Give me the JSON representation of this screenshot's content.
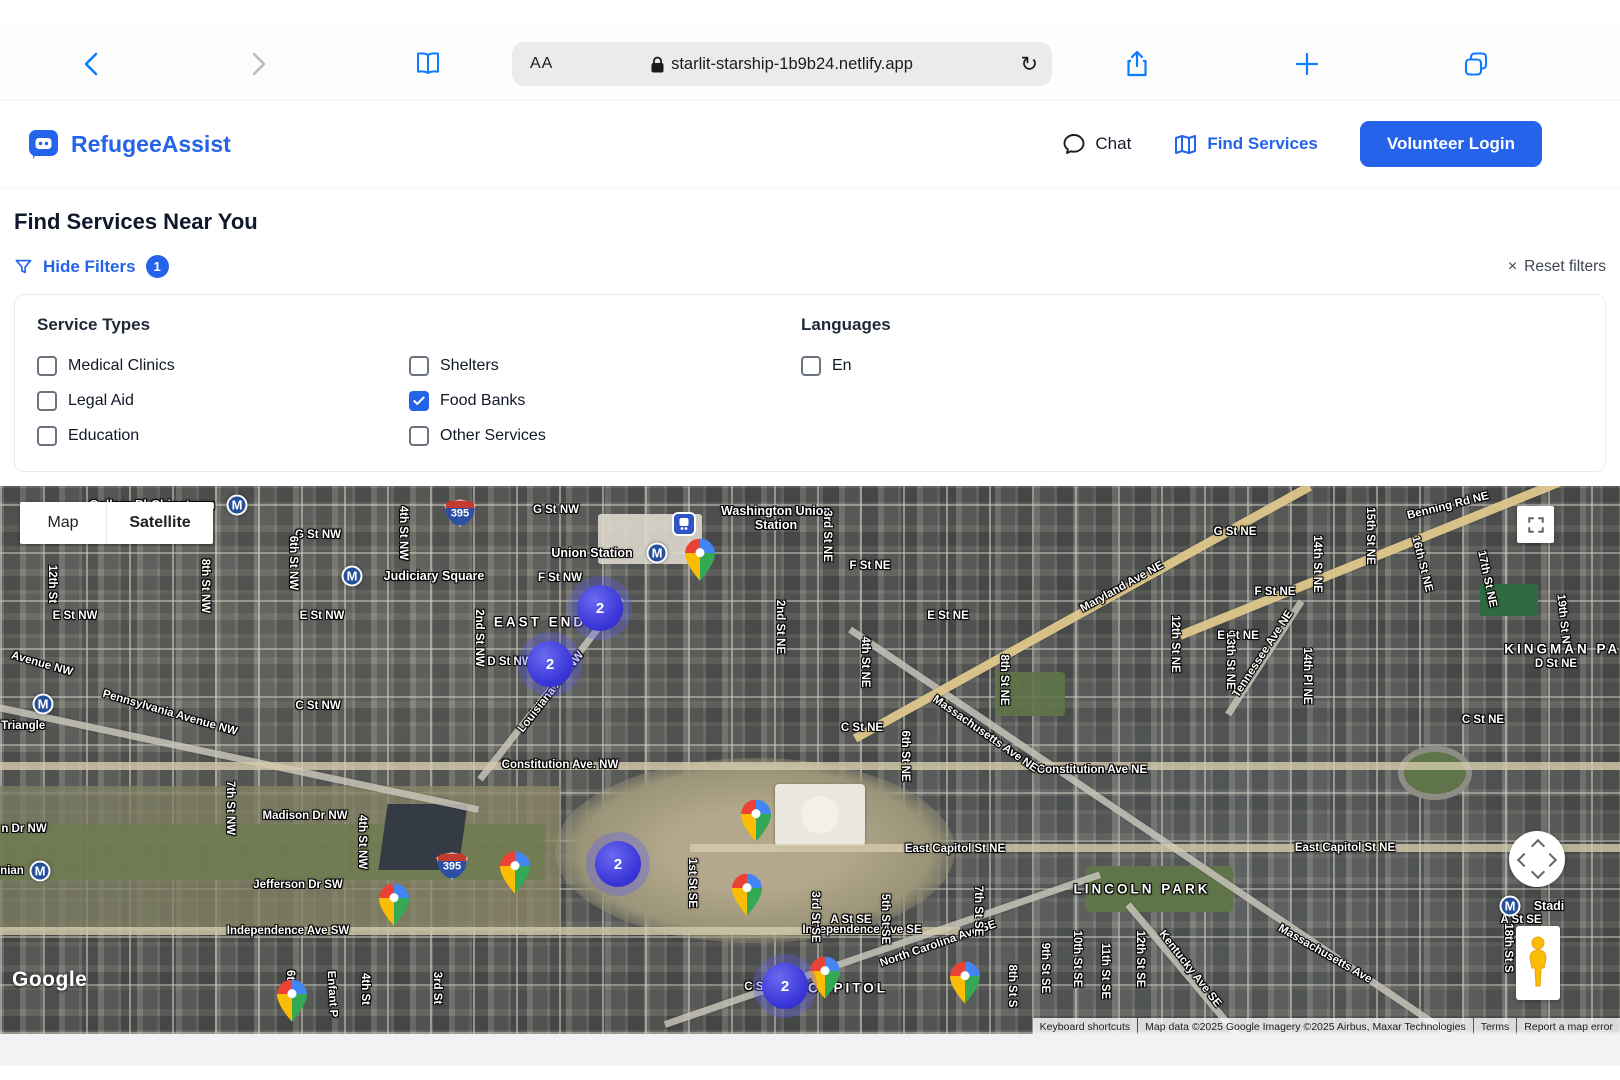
{
  "browser": {
    "text_size_label": "AA",
    "url": "starlit-starship-1b9b24.netlify.app",
    "reload_glyph": "↻"
  },
  "header": {
    "brand": "RefugeeAssist",
    "nav_chat": "Chat",
    "nav_find_services": "Find Services",
    "login": "Volunteer Login"
  },
  "page": {
    "title": "Find Services Near You",
    "hide_filters": "Hide Filters",
    "filter_count": "1",
    "reset_glyph": "×",
    "reset": "Reset filters"
  },
  "filters": {
    "service_types_label": "Service Types",
    "services": [
      {
        "label": "Medical Clinics",
        "checked": false
      },
      {
        "label": "Legal Aid",
        "checked": false
      },
      {
        "label": "Education",
        "checked": false
      },
      {
        "label": "Shelters",
        "checked": false
      },
      {
        "label": "Food Banks",
        "checked": true
      },
      {
        "label": "Other Services",
        "checked": false
      }
    ],
    "languages_label": "Languages",
    "languages": [
      {
        "label": "En",
        "checked": false
      }
    ]
  },
  "map": {
    "toggle_map": "Map",
    "toggle_satellite": "Satellite",
    "google_logo": "Google",
    "attribution": [
      "Keyboard shortcuts",
      "Map data ©2025 Google Imagery ©2025 Airbus, Maxar Technologies",
      "Terms",
      "Report a map error"
    ],
    "accent_colors": {
      "brand_blue": "#2563eb",
      "cluster_blue": "#3a35d8",
      "pin_red": "#EA4335",
      "pin_blue": "#4285F4",
      "pin_green": "#34A853",
      "pin_yellow": "#FBBC04"
    },
    "clusters": [
      {
        "x": 600,
        "y": 122,
        "count": "2"
      },
      {
        "x": 550,
        "y": 178,
        "count": "2"
      },
      {
        "x": 618,
        "y": 378,
        "count": "2"
      },
      {
        "x": 785,
        "y": 500,
        "count": "2"
      }
    ],
    "pins": [
      {
        "x": 700,
        "y": 77
      },
      {
        "x": 756,
        "y": 338
      },
      {
        "x": 515,
        "y": 390
      },
      {
        "x": 394,
        "y": 422
      },
      {
        "x": 747,
        "y": 412
      },
      {
        "x": 825,
        "y": 495
      },
      {
        "x": 965,
        "y": 500
      },
      {
        "x": 292,
        "y": 518
      }
    ],
    "metro_stations": [
      {
        "x": 237,
        "y": 19
      },
      {
        "x": 352,
        "y": 90
      },
      {
        "x": 657,
        "y": 67
      },
      {
        "x": 43,
        "y": 218
      },
      {
        "x": 40,
        "y": 385
      },
      {
        "x": 1510,
        "y": 420
      }
    ],
    "transit_icon": {
      "x": 684,
      "y": 38
    },
    "shields": [
      {
        "x": 460,
        "y": 27,
        "label": "395"
      },
      {
        "x": 452,
        "y": 380,
        "label": "395"
      }
    ],
    "labels": [
      {
        "t": "Gallery Pl-Chinatown",
        "x": 152,
        "y": 19,
        "r": 0,
        "k": "sta"
      },
      {
        "t": "G St NW",
        "x": 318,
        "y": 49,
        "r": 0,
        "k": "st"
      },
      {
        "t": "G St NW",
        "x": 556,
        "y": 24,
        "r": 0,
        "k": "st"
      },
      {
        "t": "Judiciary Square",
        "x": 434,
        "y": 90,
        "r": 0,
        "k": "sta"
      },
      {
        "t": "Union Station",
        "x": 592,
        "y": 67,
        "r": 0,
        "k": "sta"
      },
      {
        "t": "Washington Union Station",
        "x": 776,
        "y": 32,
        "r": 0,
        "k": "sta2"
      },
      {
        "t": "F St NW",
        "x": 560,
        "y": 92,
        "r": 0,
        "k": "st"
      },
      {
        "t": "EAST END",
        "x": 540,
        "y": 136,
        "r": 0,
        "k": "area"
      },
      {
        "t": "E St NW",
        "x": 75,
        "y": 130,
        "r": 0,
        "k": "st"
      },
      {
        "t": "E St NW",
        "x": 322,
        "y": 130,
        "r": 0,
        "k": "st"
      },
      {
        "t": "D St NW",
        "x": 510,
        "y": 176,
        "r": 0,
        "k": "st"
      },
      {
        "t": "C St NW",
        "x": 318,
        "y": 220,
        "r": 0,
        "k": "st"
      },
      {
        "t": "Madison Dr NW",
        "x": 305,
        "y": 330,
        "r": 0,
        "k": "st"
      },
      {
        "t": "n Dr NW",
        "x": 24,
        "y": 343,
        "r": 0,
        "k": "st"
      },
      {
        "t": "Jefferson Dr SW",
        "x": 298,
        "y": 399,
        "r": 0,
        "k": "st"
      },
      {
        "t": "Independence Ave SW",
        "x": 288,
        "y": 445,
        "r": 0,
        "k": "st"
      },
      {
        "t": "Independence Ave SE",
        "x": 862,
        "y": 444,
        "r": 0,
        "k": "st"
      },
      {
        "t": "Constitution Ave. NW",
        "x": 560,
        "y": 279,
        "r": 0,
        "k": "st"
      },
      {
        "t": "Constitution Ave NE",
        "x": 1092,
        "y": 284,
        "r": 0,
        "k": "st"
      },
      {
        "t": "l Triangle",
        "x": 20,
        "y": 240,
        "r": 0,
        "k": "st"
      },
      {
        "t": "nian",
        "x": 12,
        "y": 385,
        "r": 0,
        "k": "st"
      },
      {
        "t": "Avenue NW",
        "x": 42,
        "y": 178,
        "r": 16,
        "k": "st"
      },
      {
        "t": "Pennsylvania Avenue NW",
        "x": 170,
        "y": 227,
        "r": 16,
        "k": "st"
      },
      {
        "t": "Louisiana Ave NW",
        "x": 551,
        "y": 206,
        "r": -52,
        "k": "st"
      },
      {
        "t": "Massachusetts Ave NE",
        "x": 985,
        "y": 248,
        "r": 35,
        "k": "st"
      },
      {
        "t": "Massachusetts Ave",
        "x": 1325,
        "y": 468,
        "r": 30,
        "k": "st"
      },
      {
        "t": "Maryland Ave NE",
        "x": 1122,
        "y": 101,
        "r": -29,
        "k": "st"
      },
      {
        "t": "Tennessee Ave NE",
        "x": 1263,
        "y": 168,
        "r": -57,
        "k": "st"
      },
      {
        "t": "North Carolina Ave SE",
        "x": 938,
        "y": 458,
        "r": -19,
        "k": "st"
      },
      {
        "t": "Benning Rd NE",
        "x": 1448,
        "y": 20,
        "r": -14,
        "k": "st"
      },
      {
        "t": "Kentucky Ave SE",
        "x": 1190,
        "y": 483,
        "r": 52,
        "k": "st"
      },
      {
        "t": "East Capitol St NE",
        "x": 955,
        "y": 363,
        "r": 0,
        "k": "st"
      },
      {
        "t": "East Capitol St NE",
        "x": 1345,
        "y": 362,
        "r": 0,
        "k": "st"
      },
      {
        "t": "LINCOLN PARK",
        "x": 1142,
        "y": 403,
        "r": 0,
        "k": "area"
      },
      {
        "t": "KINGMAN PARK",
        "x": 1575,
        "y": 163,
        "r": 0,
        "k": "area"
      },
      {
        "t": "CAPITOL",
        "x": 848,
        "y": 502,
        "r": 0,
        "k": "area"
      },
      {
        "t": "C St NE",
        "x": 862,
        "y": 242,
        "r": 0,
        "k": "st"
      },
      {
        "t": "C St NE",
        "x": 1483,
        "y": 234,
        "r": 0,
        "k": "st"
      },
      {
        "t": "C St SE",
        "x": 765,
        "y": 501,
        "r": 0,
        "k": "st"
      },
      {
        "t": "A St SE",
        "x": 851,
        "y": 434,
        "r": 0,
        "k": "st"
      },
      {
        "t": "A St SE",
        "x": 1521,
        "y": 434,
        "r": 0,
        "k": "st"
      },
      {
        "t": "F St NE",
        "x": 870,
        "y": 80,
        "r": 0,
        "k": "st"
      },
      {
        "t": "E St NE",
        "x": 948,
        "y": 130,
        "r": 0,
        "k": "st"
      },
      {
        "t": "G St NE",
        "x": 1235,
        "y": 46,
        "r": 0,
        "k": "st"
      },
      {
        "t": "F St NE",
        "x": 1275,
        "y": 106,
        "r": 0,
        "k": "st"
      },
      {
        "t": "E St NE",
        "x": 1238,
        "y": 150,
        "r": 0,
        "k": "st"
      },
      {
        "t": "D St NE",
        "x": 1556,
        "y": 178,
        "r": 0,
        "k": "st"
      },
      {
        "t": "12th St",
        "x": 52,
        "y": 98,
        "r": 90,
        "k": "st"
      },
      {
        "t": "8th St NW",
        "x": 205,
        "y": 100,
        "r": 90,
        "k": "st"
      },
      {
        "t": "6th St NW",
        "x": 293,
        "y": 77,
        "r": 90,
        "k": "st"
      },
      {
        "t": "4th St NW",
        "x": 403,
        "y": 47,
        "r": 90,
        "k": "st"
      },
      {
        "t": "2nd St NW",
        "x": 479,
        "y": 152,
        "r": 90,
        "k": "st"
      },
      {
        "t": "2nd St NE",
        "x": 780,
        "y": 141,
        "r": 90,
        "k": "st"
      },
      {
        "t": "3rd St NE",
        "x": 827,
        "y": 50,
        "r": 90,
        "k": "st"
      },
      {
        "t": "4th St NE",
        "x": 865,
        "y": 176,
        "r": 90,
        "k": "st"
      },
      {
        "t": "6th St NE",
        "x": 905,
        "y": 270,
        "r": 90,
        "k": "st"
      },
      {
        "t": "8th St NE",
        "x": 1004,
        "y": 194,
        "r": 90,
        "k": "st"
      },
      {
        "t": "7th St NW",
        "x": 230,
        "y": 322,
        "r": 90,
        "k": "st"
      },
      {
        "t": "4th St NW",
        "x": 362,
        "y": 356,
        "r": 90,
        "k": "st"
      },
      {
        "t": "6th St",
        "x": 290,
        "y": 500,
        "r": 90,
        "k": "st"
      },
      {
        "t": "4th St",
        "x": 365,
        "y": 503,
        "r": 90,
        "k": "st"
      },
      {
        "t": "3rd St",
        "x": 437,
        "y": 502,
        "r": 90,
        "k": "st"
      },
      {
        "t": "1st St SE",
        "x": 692,
        "y": 397,
        "r": 90,
        "k": "st"
      },
      {
        "t": "3rd St SE",
        "x": 815,
        "y": 431,
        "r": 90,
        "k": "st"
      },
      {
        "t": "5th St SE",
        "x": 885,
        "y": 433,
        "r": 90,
        "k": "st"
      },
      {
        "t": "7th St SE",
        "x": 978,
        "y": 425,
        "r": 90,
        "k": "st"
      },
      {
        "t": "8th St S",
        "x": 1012,
        "y": 500,
        "r": 90,
        "k": "st"
      },
      {
        "t": "9th St SE",
        "x": 1045,
        "y": 482,
        "r": 90,
        "k": "st"
      },
      {
        "t": "10th St SE",
        "x": 1077,
        "y": 473,
        "r": 90,
        "k": "st"
      },
      {
        "t": "11th St SE",
        "x": 1105,
        "y": 485,
        "r": 90,
        "k": "st"
      },
      {
        "t": "12th St SE",
        "x": 1140,
        "y": 473,
        "r": 90,
        "k": "st"
      },
      {
        "t": "12th St NE",
        "x": 1175,
        "y": 158,
        "r": 90,
        "k": "st"
      },
      {
        "t": "13th St NE",
        "x": 1230,
        "y": 175,
        "r": 90,
        "k": "st"
      },
      {
        "t": "14th Pl NE",
        "x": 1307,
        "y": 190,
        "r": 90,
        "k": "st"
      },
      {
        "t": "14th St NE",
        "x": 1317,
        "y": 78,
        "r": 90,
        "k": "st"
      },
      {
        "t": "15th St NE",
        "x": 1370,
        "y": 50,
        "r": 90,
        "k": "st"
      },
      {
        "t": "16th St NE",
        "x": 1422,
        "y": 78,
        "r": 76,
        "k": "st"
      },
      {
        "t": "17th St NE",
        "x": 1487,
        "y": 93,
        "r": 78,
        "k": "st"
      },
      {
        "t": "19th St N",
        "x": 1563,
        "y": 133,
        "r": 84,
        "k": "st"
      },
      {
        "t": "18th St S",
        "x": 1508,
        "y": 462,
        "r": 90,
        "k": "st"
      },
      {
        "t": "Enfant P",
        "x": 332,
        "y": 508,
        "r": 87,
        "k": "st"
      },
      {
        "t": "Stadi",
        "x": 1549,
        "y": 420,
        "r": 0,
        "k": "sta"
      }
    ]
  }
}
